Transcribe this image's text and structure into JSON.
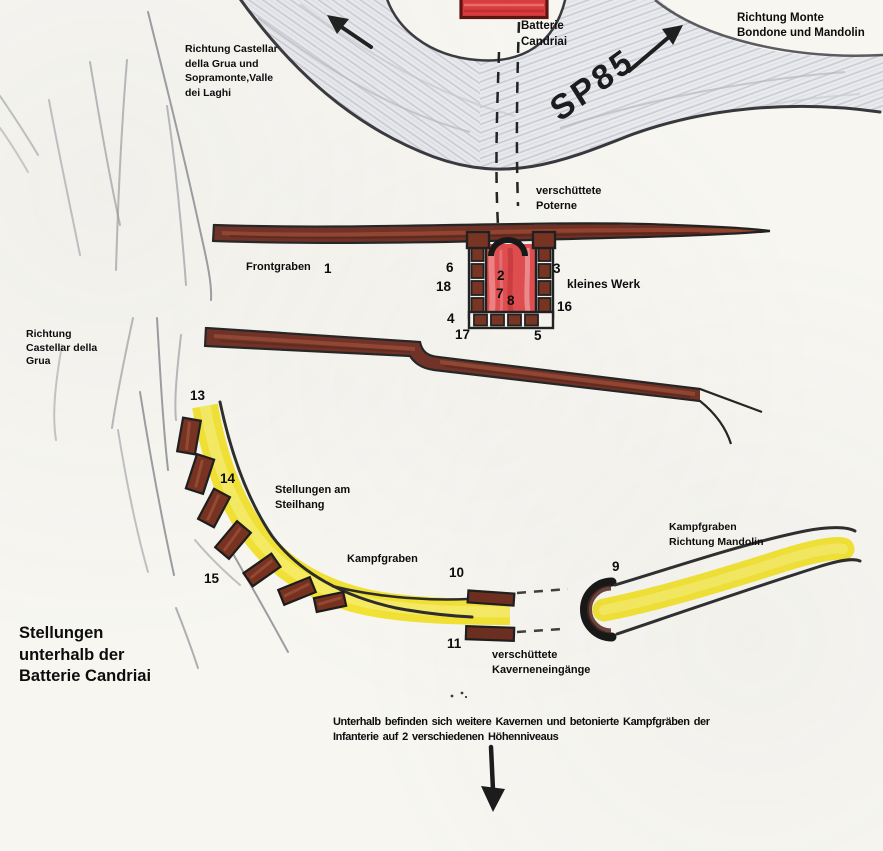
{
  "map": {
    "title": "Stellungen\nunterhalb der\nBatterie Candriai",
    "battery_label": "Batterie\nCandriai",
    "road_name": "SP85",
    "note": "Unterhalb befinden sich weitere Kavernen und betonierte Kampfgräben der\nInfanterie auf 2 verschiedenen Höhenniveaus"
  },
  "directions": {
    "northwest": "Richtung Castellar\ndella Grua und\nSopramonte,Valle\ndei Laghi",
    "northeast": "Richtung Monte\nBondone und Mandolin",
    "west": "Richtung\nCastellar della\nGrua"
  },
  "features": {
    "poterne": "verschüttete\nPoterne",
    "frontgraben": "Frontgraben",
    "kleines_werk": "kleines Werk",
    "steilhang": "Stellungen am\nSteilhang",
    "kampfgraben": "Kampfgraben",
    "kampfgraben_mandolin": "Kampfgraben\nRichtung Mandolin",
    "kaverneneingaenge": "verschüttete\nKaverneneingänge"
  },
  "markers": [
    {
      "n": "1",
      "x": 324,
      "y": 261
    },
    {
      "n": "2",
      "x": 497,
      "y": 268
    },
    {
      "n": "3",
      "x": 553,
      "y": 261
    },
    {
      "n": "4",
      "x": 447,
      "y": 311
    },
    {
      "n": "5",
      "x": 534,
      "y": 328
    },
    {
      "n": "6",
      "x": 446,
      "y": 260
    },
    {
      "n": "7",
      "x": 496,
      "y": 286
    },
    {
      "n": "8",
      "x": 507,
      "y": 293
    },
    {
      "n": "9",
      "x": 612,
      "y": 559
    },
    {
      "n": "10",
      "x": 449,
      "y": 565
    },
    {
      "n": "11",
      "x": 447,
      "y": 636
    },
    {
      "n": "13",
      "x": 190,
      "y": 388
    },
    {
      "n": "14",
      "x": 220,
      "y": 471
    },
    {
      "n": "15",
      "x": 204,
      "y": 571
    },
    {
      "n": "16",
      "x": 557,
      "y": 299
    },
    {
      "n": "17",
      "x": 455,
      "y": 327
    },
    {
      "n": "18",
      "x": 436,
      "y": 279
    }
  ],
  "colors": {
    "paper": "#f7f6f1",
    "ink": "#0d0d0d",
    "road_gray": "#e9eaed",
    "trench_brown": "#6f2f22",
    "fort_red": "#e04b4d",
    "path_yellow": "#f2e233"
  }
}
